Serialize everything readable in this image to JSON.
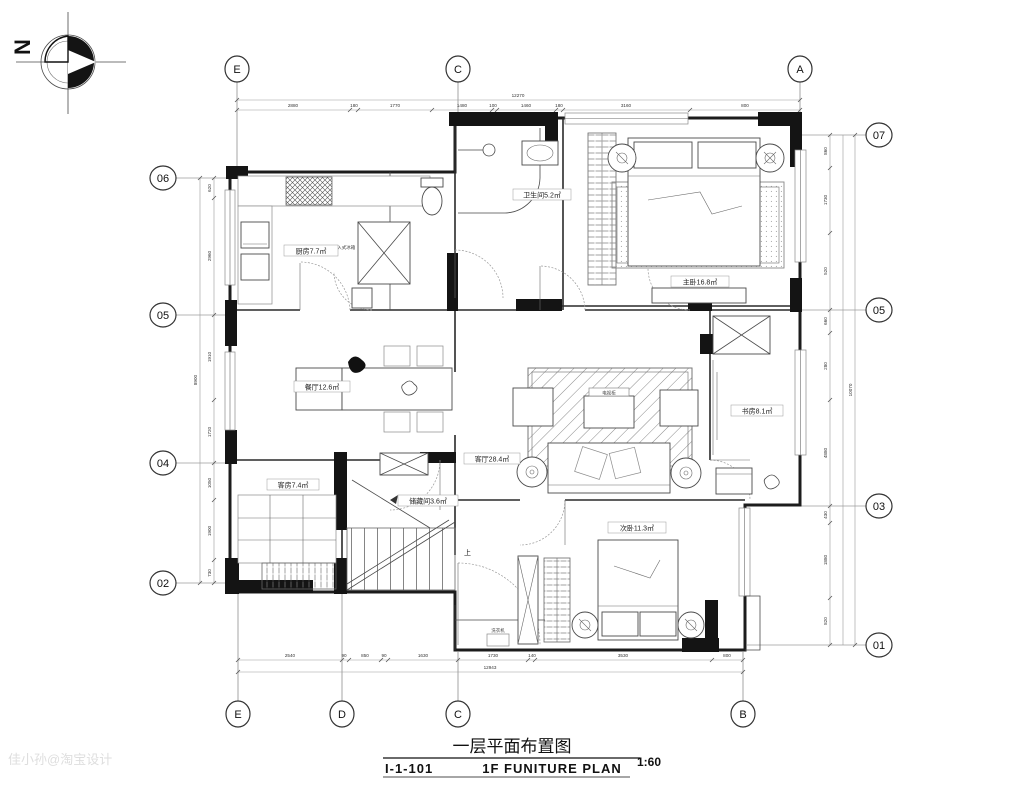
{
  "compass": {
    "label": "N"
  },
  "title_block": {
    "cn": "一层平面布置图",
    "code": "I-1-101",
    "en": "1F FUNITURE PLAN",
    "scale": "1:60"
  },
  "watermark": "佳小孙@淘宝设计",
  "grid": {
    "top": [
      "E",
      "C",
      "A"
    ],
    "bottom": [
      "E",
      "D",
      "C",
      "B"
    ],
    "left": [
      "06",
      "05",
      "04",
      "02"
    ],
    "right": [
      "07",
      "05",
      "03",
      "01"
    ]
  },
  "rooms": {
    "kitchen": "厨房7.7㎡",
    "bath": "卫生间5.2㎡",
    "master": "主卧16.8㎡",
    "dining": "餐厅12.6㎡",
    "living": "客厅28.4㎡",
    "study": "书房8.1㎡",
    "bedroom2": "次卧11.3㎡",
    "guest": "客房7.4㎡",
    "storage": "储藏间3.6㎡",
    "fridge": "嵌入式冰箱",
    "tv_cabinet": "电视柜",
    "washer": "洗衣机",
    "stairs_up": "上"
  },
  "dims": {
    "top_total": "12270",
    "top": [
      "2880",
      "180",
      "1770",
      "1480",
      "100",
      "1460",
      "180",
      "3160",
      "800"
    ],
    "bottom_total": "12943",
    "bottom": [
      "2540",
      "90",
      "850",
      "90",
      "1630",
      "1730",
      "140",
      "3530",
      "800"
    ],
    "left_total": "8900",
    "left": [
      "620",
      "2960",
      "1910",
      "1720",
      "1050",
      "1900",
      "730"
    ],
    "right_total": "10070",
    "right": [
      "860",
      "1730",
      "520",
      "660",
      "280",
      "4880",
      "430",
      "1880",
      "820"
    ]
  }
}
